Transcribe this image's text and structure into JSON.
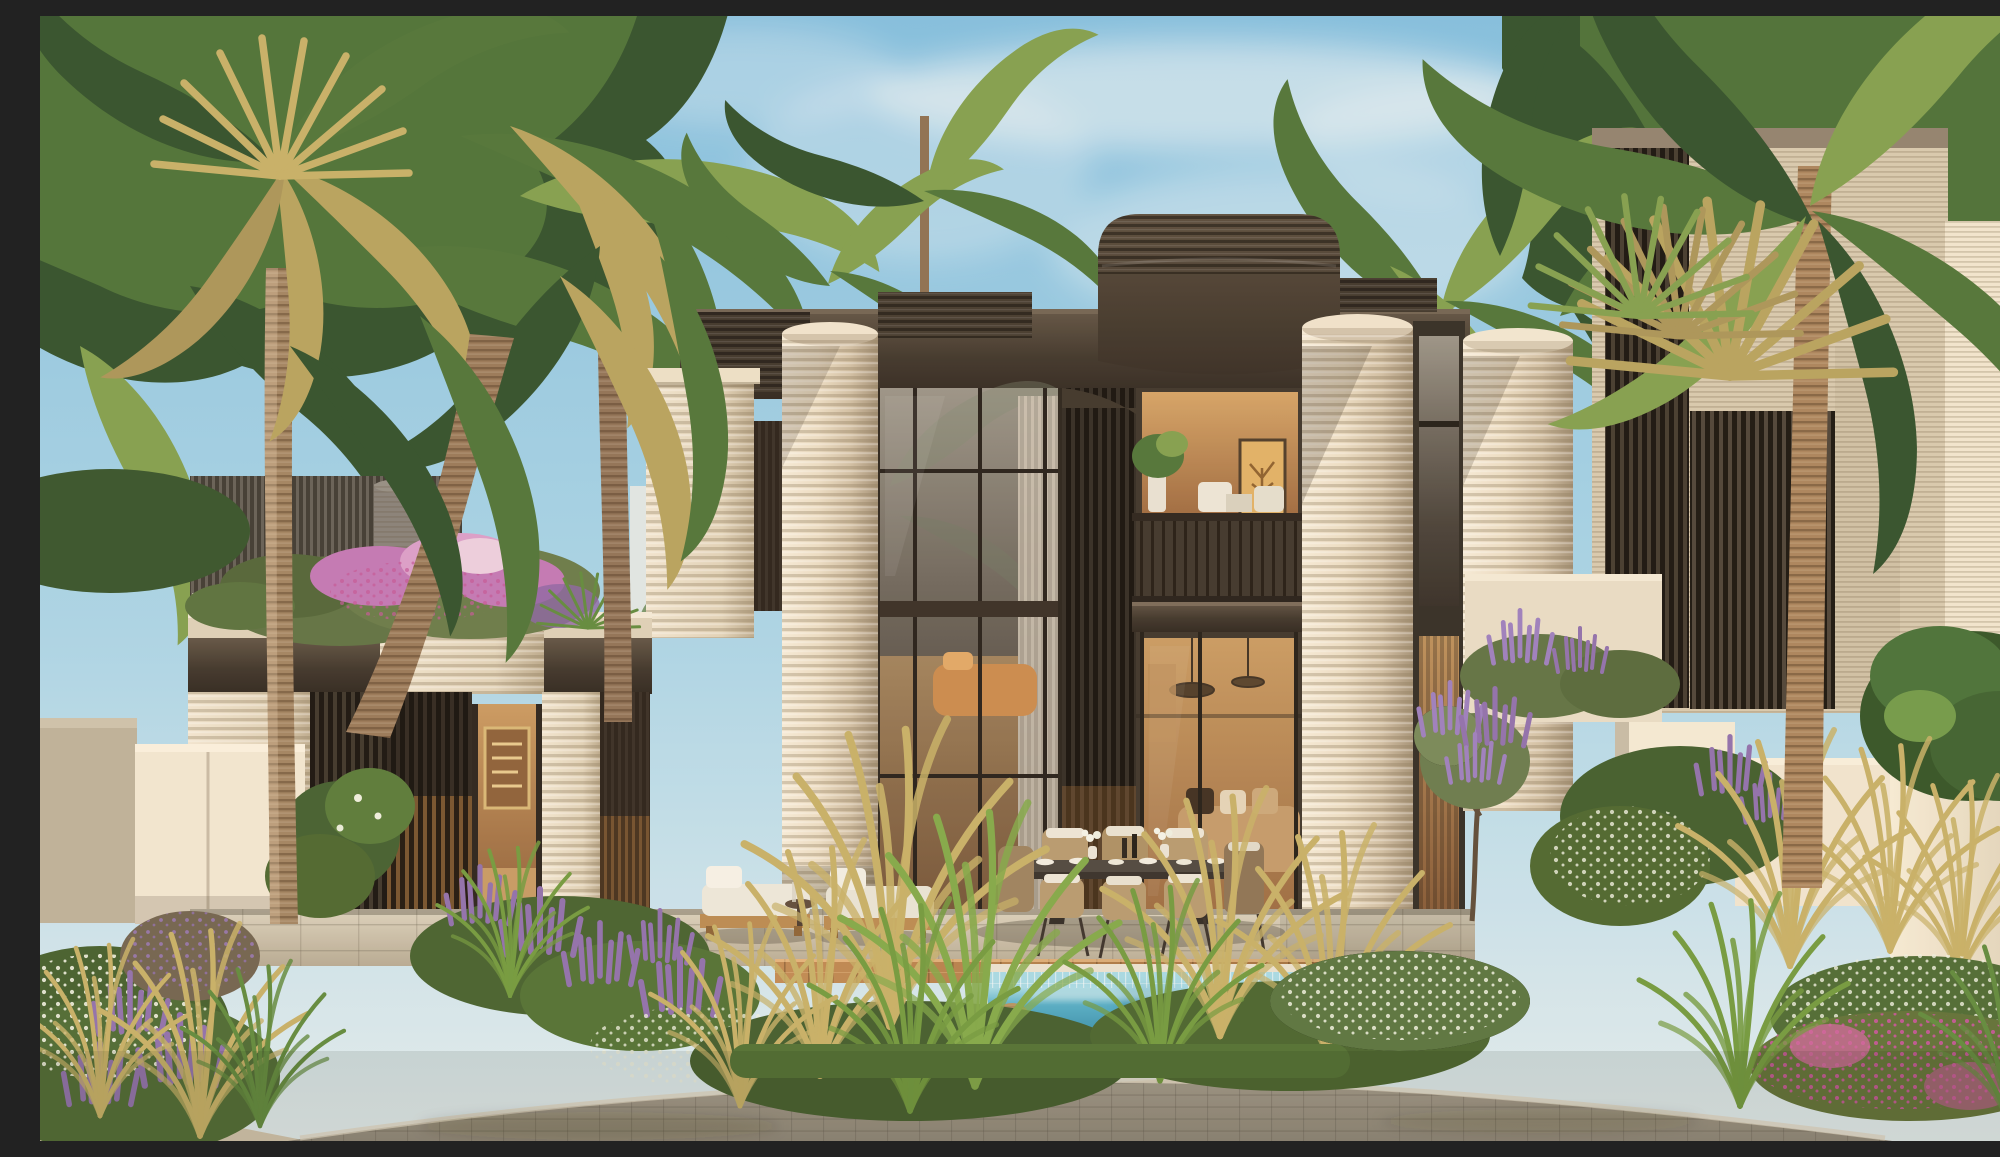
{
  "meta": {
    "alt": "Sunlit rendering of a modern two-storey villa with ribbed cream cylindrical walls, dark bronze fascia, floor-to-ceiling glazing and a balcony, framed by tall palm trees, flowering gardens, a turquoise lap pool with timber deck, sun loungers, an outdoor dining set and a curved paver driveway under a pale blue sky."
  },
  "palette": {
    "sky_top": "#7fc0e5",
    "sky_mid": "#a9d7ec",
    "sky_low": "#e4f0f5",
    "cloud": "#f4fafc",
    "bronze": "#453c32",
    "cream": "#e6dbc5",
    "drive": "#9d968a",
    "pool_tile": "#a5dcea",
    "pool_water": "#4facc9",
    "pool_deep": "#2f8cab",
    "wood": "#c08a54",
    "wood_dark": "#9a6c3e",
    "palm_dark": "#2d4f2c",
    "palm_mid": "#4c7439",
    "palm_light": "#7fa04f",
    "palm_gold": "#b5a35f",
    "flower_purple": "#8d6fb0",
    "grass_gold": "#c5b169",
    "grass_green": "#6f9a3f",
    "flower_white": "#eef2e4",
    "flower_mag": "#c2559a",
    "flower_bougainvillea": "#c177b8"
  },
  "scene": {
    "time_of_day": "late afternoon sun from the left",
    "villa_storeys": 2,
    "sun_loungers": 2,
    "dining_chairs": 6,
    "balconies": 1,
    "pools": 1,
    "palm_trunks_visible": 4
  }
}
